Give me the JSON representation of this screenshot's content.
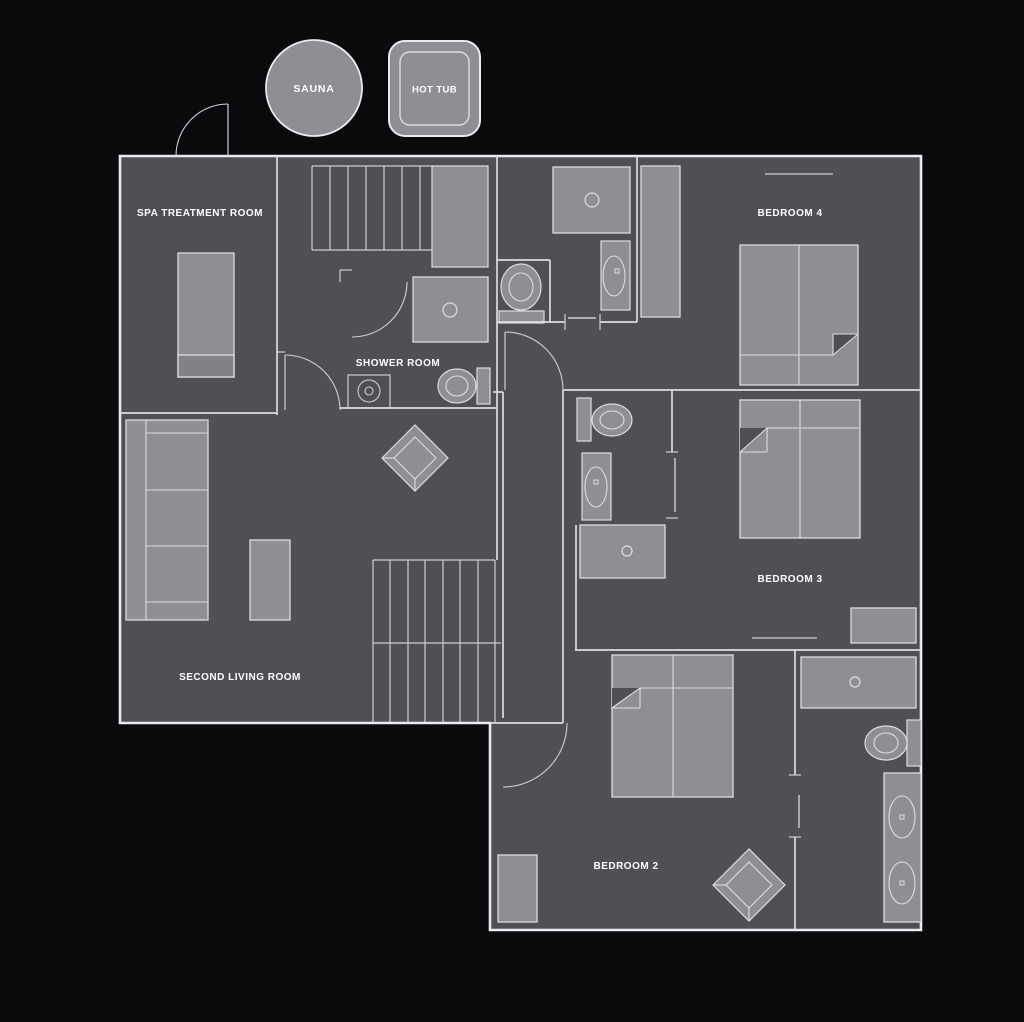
{
  "title": "First floor plan",
  "colors": {
    "background": "#0a0a0c",
    "floor": "#504f55",
    "wall_outer": "#eaeaed",
    "wall": "#dddce1",
    "line": "#cfced4",
    "furniture": "#8f8e93",
    "furniture_dark": "#838289",
    "furniture_stroke": "#dddce1",
    "text": "#ffffff"
  },
  "outdoor": {
    "sauna": {
      "label": "SAUNA",
      "cx": 314,
      "cy": 88,
      "r": 48
    },
    "hot_tub": {
      "label": "HOT TUB",
      "x": 389,
      "y": 41,
      "w": 91,
      "h": 95,
      "inner_inset": 11
    }
  },
  "rooms": [
    {
      "id": "spa-treatment-room",
      "label": "SPA TREATMENT ROOM",
      "cx": 200,
      "cy": 212
    },
    {
      "id": "shower-room",
      "label": "SHOWER ROOM",
      "cx": 398,
      "cy": 362
    },
    {
      "id": "second-living-room",
      "label": "SECOND LIVING ROOM",
      "cx": 240,
      "cy": 676
    },
    {
      "id": "bedroom-4",
      "label": "BEDROOM 4",
      "cx": 790,
      "cy": 212
    },
    {
      "id": "bedroom-3",
      "label": "BEDROOM 3",
      "cx": 790,
      "cy": 578
    },
    {
      "id": "bedroom-2",
      "label": "BEDROOM 2",
      "cx": 626,
      "cy": 865
    }
  ],
  "plan": {
    "outline": "M120,156 L921,156 L921,930 L490,930 L490,723 L120,723 Z",
    "walls": [
      [
        277,
        156,
        277,
        415
      ],
      [
        120,
        413,
        277,
        413
      ],
      [
        340,
        408,
        497,
        408
      ],
      [
        497,
        156,
        497,
        560
      ],
      [
        497,
        260,
        550,
        260
      ],
      [
        550,
        260,
        550,
        322
      ],
      [
        497,
        322,
        565,
        322
      ],
      [
        600,
        322,
        637,
        322
      ],
      [
        637,
        156,
        637,
        322
      ],
      [
        563,
        390,
        921,
        390
      ],
      [
        672,
        390,
        672,
        452
      ],
      [
        575,
        650,
        921,
        650
      ],
      [
        795,
        650,
        795,
        775
      ],
      [
        795,
        837,
        795,
        930
      ],
      [
        503,
        392,
        503,
        718
      ],
      [
        563,
        390,
        563,
        723
      ],
      [
        490,
        723,
        563,
        723
      ],
      [
        576,
        525,
        576,
        650
      ],
      [
        493,
        392,
        503,
        392
      ]
    ],
    "door_leaves": [
      [
        228,
        104,
        228,
        156
      ],
      [
        285,
        355,
        285,
        410
      ],
      [
        505,
        332,
        505,
        390
      ]
    ],
    "ticks": [
      [
        565,
        314,
        565,
        330
      ],
      [
        600,
        314,
        600,
        330
      ],
      [
        666,
        452,
        678,
        452
      ],
      [
        666,
        518,
        678,
        518
      ],
      [
        789,
        775,
        801,
        775
      ],
      [
        789,
        837,
        801,
        837
      ],
      [
        340,
        270,
        352,
        270
      ],
      [
        340,
        270,
        340,
        282
      ],
      [
        276,
        352,
        285,
        352
      ]
    ],
    "slides": [
      [
        568,
        318,
        596,
        318
      ],
      [
        675,
        458,
        675,
        512
      ],
      [
        799,
        795,
        799,
        828
      ]
    ],
    "windows": [
      [
        765,
        174,
        833,
        174
      ],
      [
        752,
        638,
        817,
        638
      ]
    ],
    "door_arcs": [
      "M176,156 A52,52 0 0 1 228,104",
      "M285,355 A55,55 0 0 1 340,410",
      "M407,282 A55,55 0 0 1 352,337",
      "M505,332 A58,58 0 0 1 563,390",
      "M567,723 A64,64 0 0 1 503,787"
    ],
    "stairs": [
      {
        "name": "stairs-upper",
        "edges": [
          [
            312,
            166,
            432,
            166
          ],
          [
            312,
            250,
            432,
            250
          ],
          [
            312,
            166,
            312,
            250
          ]
        ],
        "treads_x": [
          330,
          348,
          366,
          384,
          402,
          420
        ],
        "y1": 166,
        "y2": 250
      },
      {
        "name": "stairs-lower",
        "edges": [
          [
            373,
            560,
            495,
            560
          ],
          [
            373,
            643,
            501,
            643
          ]
        ],
        "treads_x": [
          373,
          390,
          408,
          425,
          443,
          460,
          478,
          495
        ],
        "y1": 560,
        "y2": 722
      }
    ],
    "landing": {
      "x": 432,
      "y": 166,
      "w": 56,
      "h": 101
    }
  },
  "furniture": [
    {
      "name": "massage-table",
      "type": "rect",
      "rect": [
        178,
        253,
        56,
        124
      ]
    },
    {
      "name": "massage-table-foot",
      "type": "rect",
      "rect": [
        178,
        355,
        56,
        22
      ],
      "fill": "furniture_dark"
    },
    {
      "name": "sofa",
      "type": "bed",
      "rect": [
        126,
        420,
        82,
        200
      ],
      "lines": [
        [
          146,
          420,
          146,
          620
        ],
        [
          146,
          433,
          208,
          433
        ],
        [
          146,
          490,
          208,
          490
        ],
        [
          146,
          546,
          208,
          546
        ],
        [
          146,
          602,
          208,
          602
        ]
      ]
    },
    {
      "name": "ottoman",
      "type": "rect",
      "rect": [
        250,
        540,
        40,
        80
      ]
    },
    {
      "name": "armchair-living",
      "type": "diamond",
      "c": [
        415,
        458
      ],
      "r1": 33,
      "r2": 21
    },
    {
      "name": "shower-tray-hall",
      "type": "shower",
      "rect": [
        413,
        277,
        75,
        65
      ],
      "drain": [
        450,
        310,
        7
      ]
    },
    {
      "name": "basin-hall",
      "type": "basin",
      "rect": [
        348,
        375,
        42,
        33
      ],
      "c": [
        369,
        391
      ],
      "r": [
        11,
        4
      ]
    },
    {
      "name": "toilet-hall",
      "type": "toilet",
      "tank": [
        477,
        368,
        13,
        36
      ],
      "bowl": [
        457,
        386,
        19,
        17
      ],
      "inner": [
        11,
        10
      ]
    },
    {
      "name": "toilet-wc",
      "type": "toilet",
      "tank": [
        499,
        311,
        45,
        12
      ],
      "bowl": [
        521,
        287,
        20,
        23
      ],
      "inner": [
        12,
        14
      ]
    },
    {
      "name": "shower-tray-top",
      "type": "shower",
      "rect": [
        553,
        167,
        77,
        66
      ],
      "drain": [
        592,
        200,
        7
      ]
    },
    {
      "name": "vanity-top",
      "type": "vanity",
      "rect": [
        601,
        241,
        29,
        69
      ],
      "oval": [
        614,
        276,
        11,
        20
      ],
      "dot": [
        617,
        271
      ]
    },
    {
      "name": "wardrobe-bedroom4",
      "type": "rect",
      "rect": [
        641,
        166,
        39,
        151
      ]
    },
    {
      "name": "bed-bedroom4",
      "type": "bed",
      "rect": [
        740,
        245,
        118,
        140
      ],
      "lines": [
        [
          799,
          245,
          799,
          385
        ],
        [
          740,
          355,
          833,
          355
        ],
        [
          833,
          334,
          833,
          355
        ],
        [
          833,
          334,
          858,
          334
        ],
        [
          833,
          355,
          858,
          334
        ]
      ],
      "fold": [
        [
          833,
          334
        ],
        [
          858,
          334
        ],
        [
          833,
          355
        ]
      ]
    },
    {
      "name": "toilet-ensuite3",
      "type": "toilet",
      "tank": [
        577,
        398,
        14,
        43
      ],
      "bowl": [
        612,
        420,
        20,
        16
      ],
      "inner": [
        12,
        9
      ]
    },
    {
      "name": "vanity-ensuite3",
      "type": "vanity",
      "rect": [
        582,
        453,
        29,
        67
      ],
      "oval": [
        596,
        487,
        11,
        20
      ],
      "dot": [
        596,
        482
      ]
    },
    {
      "name": "shower-ensuite3",
      "type": "shower",
      "rect": [
        580,
        525,
        85,
        53
      ],
      "drain": [
        627,
        551,
        5
      ]
    },
    {
      "name": "bed-bedroom3",
      "type": "bed",
      "rect": [
        740,
        400,
        120,
        138
      ],
      "lines": [
        [
          800,
          400,
          800,
          538
        ],
        [
          767,
          428,
          860,
          428
        ],
        [
          767,
          428,
          767,
          452
        ],
        [
          740,
          452,
          767,
          452
        ],
        [
          740,
          452,
          767,
          428
        ]
      ],
      "fold": [
        [
          740,
          428
        ],
        [
          767,
          428
        ],
        [
          740,
          452
        ]
      ]
    },
    {
      "name": "chest-bedroom3",
      "type": "rect",
      "rect": [
        851,
        608,
        65,
        35
      ]
    },
    {
      "name": "bed-bedroom2",
      "type": "bed",
      "rect": [
        612,
        655,
        121,
        142
      ],
      "lines": [
        [
          673,
          655,
          673,
          797
        ],
        [
          640,
          688,
          733,
          688
        ],
        [
          640,
          688,
          640,
          708
        ],
        [
          612,
          708,
          640,
          708
        ],
        [
          612,
          708,
          640,
          688
        ]
      ],
      "fold": [
        [
          612,
          688
        ],
        [
          640,
          688
        ],
        [
          612,
          708
        ]
      ]
    },
    {
      "name": "nightstand-bedroom2",
      "type": "rect",
      "rect": [
        498,
        855,
        39,
        67
      ]
    },
    {
      "name": "armchair-bedroom2",
      "type": "diamond",
      "c": [
        749,
        885
      ],
      "r1": 36,
      "r2": 23
    },
    {
      "name": "shower-tray-ensuite2",
      "type": "shower",
      "rect": [
        801,
        657,
        115,
        51
      ],
      "drain": [
        855,
        682,
        5
      ]
    },
    {
      "name": "toilet-ensuite2",
      "type": "toilet",
      "tank": [
        907,
        720,
        14,
        46
      ],
      "bowl": [
        886,
        743,
        21,
        17
      ],
      "inner": [
        12,
        10
      ]
    },
    {
      "name": "double-vanity-ensuite2",
      "type": "vanity2",
      "rect": [
        884,
        773,
        37,
        149
      ],
      "ovals": [
        [
          902,
          817,
          13,
          21
        ],
        [
          902,
          883,
          13,
          21
        ]
      ],
      "dots": [
        [
          902,
          817
        ],
        [
          902,
          883
        ]
      ]
    }
  ]
}
